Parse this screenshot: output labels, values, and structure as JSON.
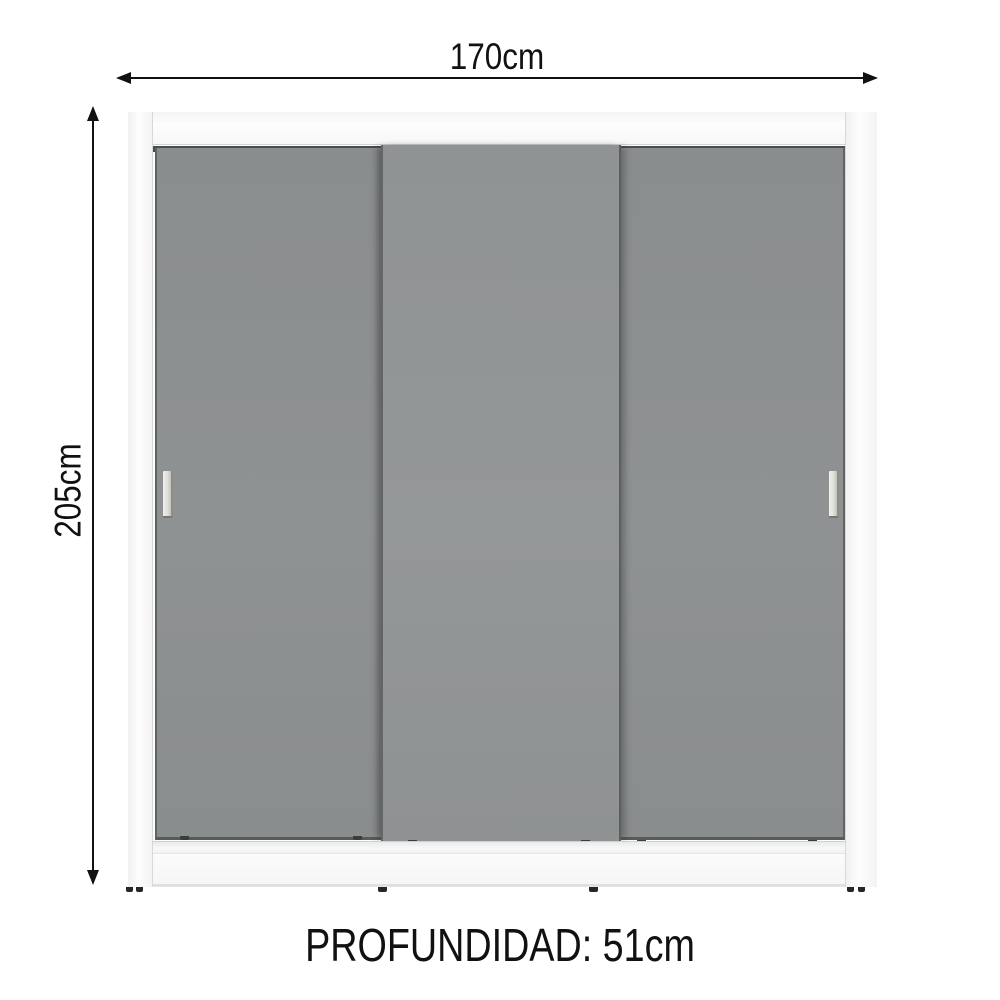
{
  "title": "Wardrobe dimension diagram, 3 sliding doors",
  "dimensions": {
    "width": "170cm",
    "height": "205cm",
    "depth": "PROFUNDIDAD: 51cm"
  },
  "wardrobe": {
    "door_count": 3,
    "handle_count": 2
  },
  "colors": {
    "background": "#ffffff",
    "frame_white": "#fcfcfc",
    "door_gray": "#8d9091",
    "front_door_gray": "#939697",
    "track_dark": "#4a4d4e",
    "handle_silver": "#eaeae2",
    "annotation_black": "#111111"
  }
}
